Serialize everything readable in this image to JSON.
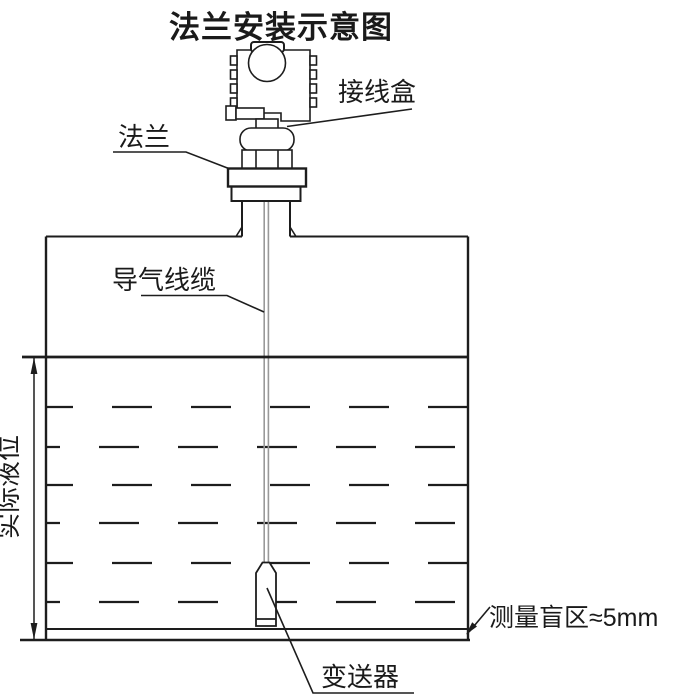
{
  "title": "法兰安装示意图",
  "labels": {
    "junction_box": "接线盒",
    "flange": "法兰",
    "air_cable": "导气线缆",
    "actual_level": "实际液位",
    "blind_zone": "测量盲区≈5mm",
    "transmitter": "变送器"
  },
  "colors": {
    "line": "#1d1d1d",
    "text": "#1a1a1a",
    "cable": "#999999",
    "background": "#ffffff"
  }
}
